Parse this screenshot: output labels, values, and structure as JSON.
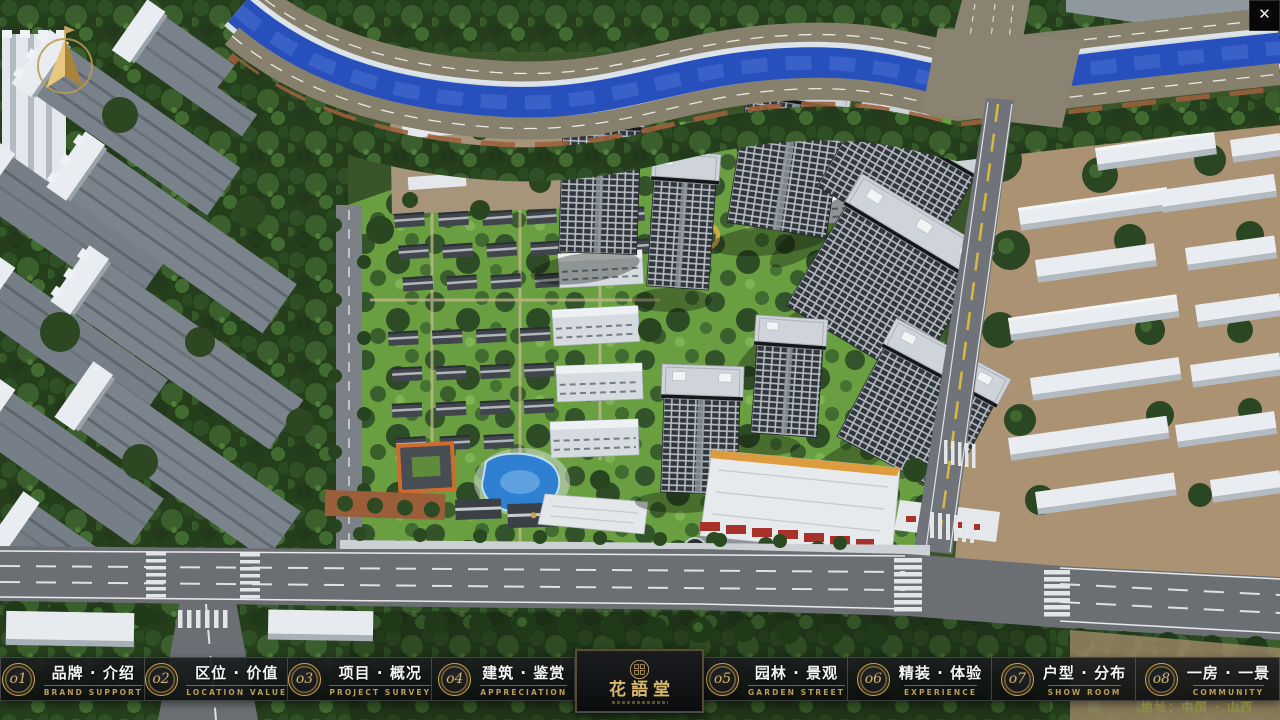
{
  "colors": {
    "gold_accent": "#cfa95c",
    "navbar_background": "#121416",
    "river_blue": "#2750bd",
    "lawn_green": "#699e41",
    "close_button_bg": "#070707"
  },
  "nav": {
    "items": [
      {
        "num": "o1",
        "zh": "品牌 · 介绍",
        "en": "BRAND SUPPORT"
      },
      {
        "num": "o2",
        "zh": "区位 · 价值",
        "en": "LOCATION VALUE"
      },
      {
        "num": "o3",
        "zh": "项目 · 概况",
        "en": "PROJECT SURVEY"
      },
      {
        "num": "o4",
        "zh": "建筑 · 鉴赏",
        "en": "APPRECIATION"
      },
      {
        "num": "o5",
        "zh": "园林 · 景观",
        "en": "GARDEN STREET"
      },
      {
        "num": "o6",
        "zh": "精装 · 体验",
        "en": "EXPERIENCE"
      },
      {
        "num": "o7",
        "zh": "户型 · 分布",
        "en": "SHOW ROOM"
      },
      {
        "num": "o8",
        "zh": "一房 · 一景",
        "en": "COMMUNITY"
      }
    ]
  },
  "logo": {
    "title": "花語堂"
  },
  "footer": {
    "address": "地址：中国 · 山西"
  },
  "window": {
    "close_glyph": "✕"
  }
}
